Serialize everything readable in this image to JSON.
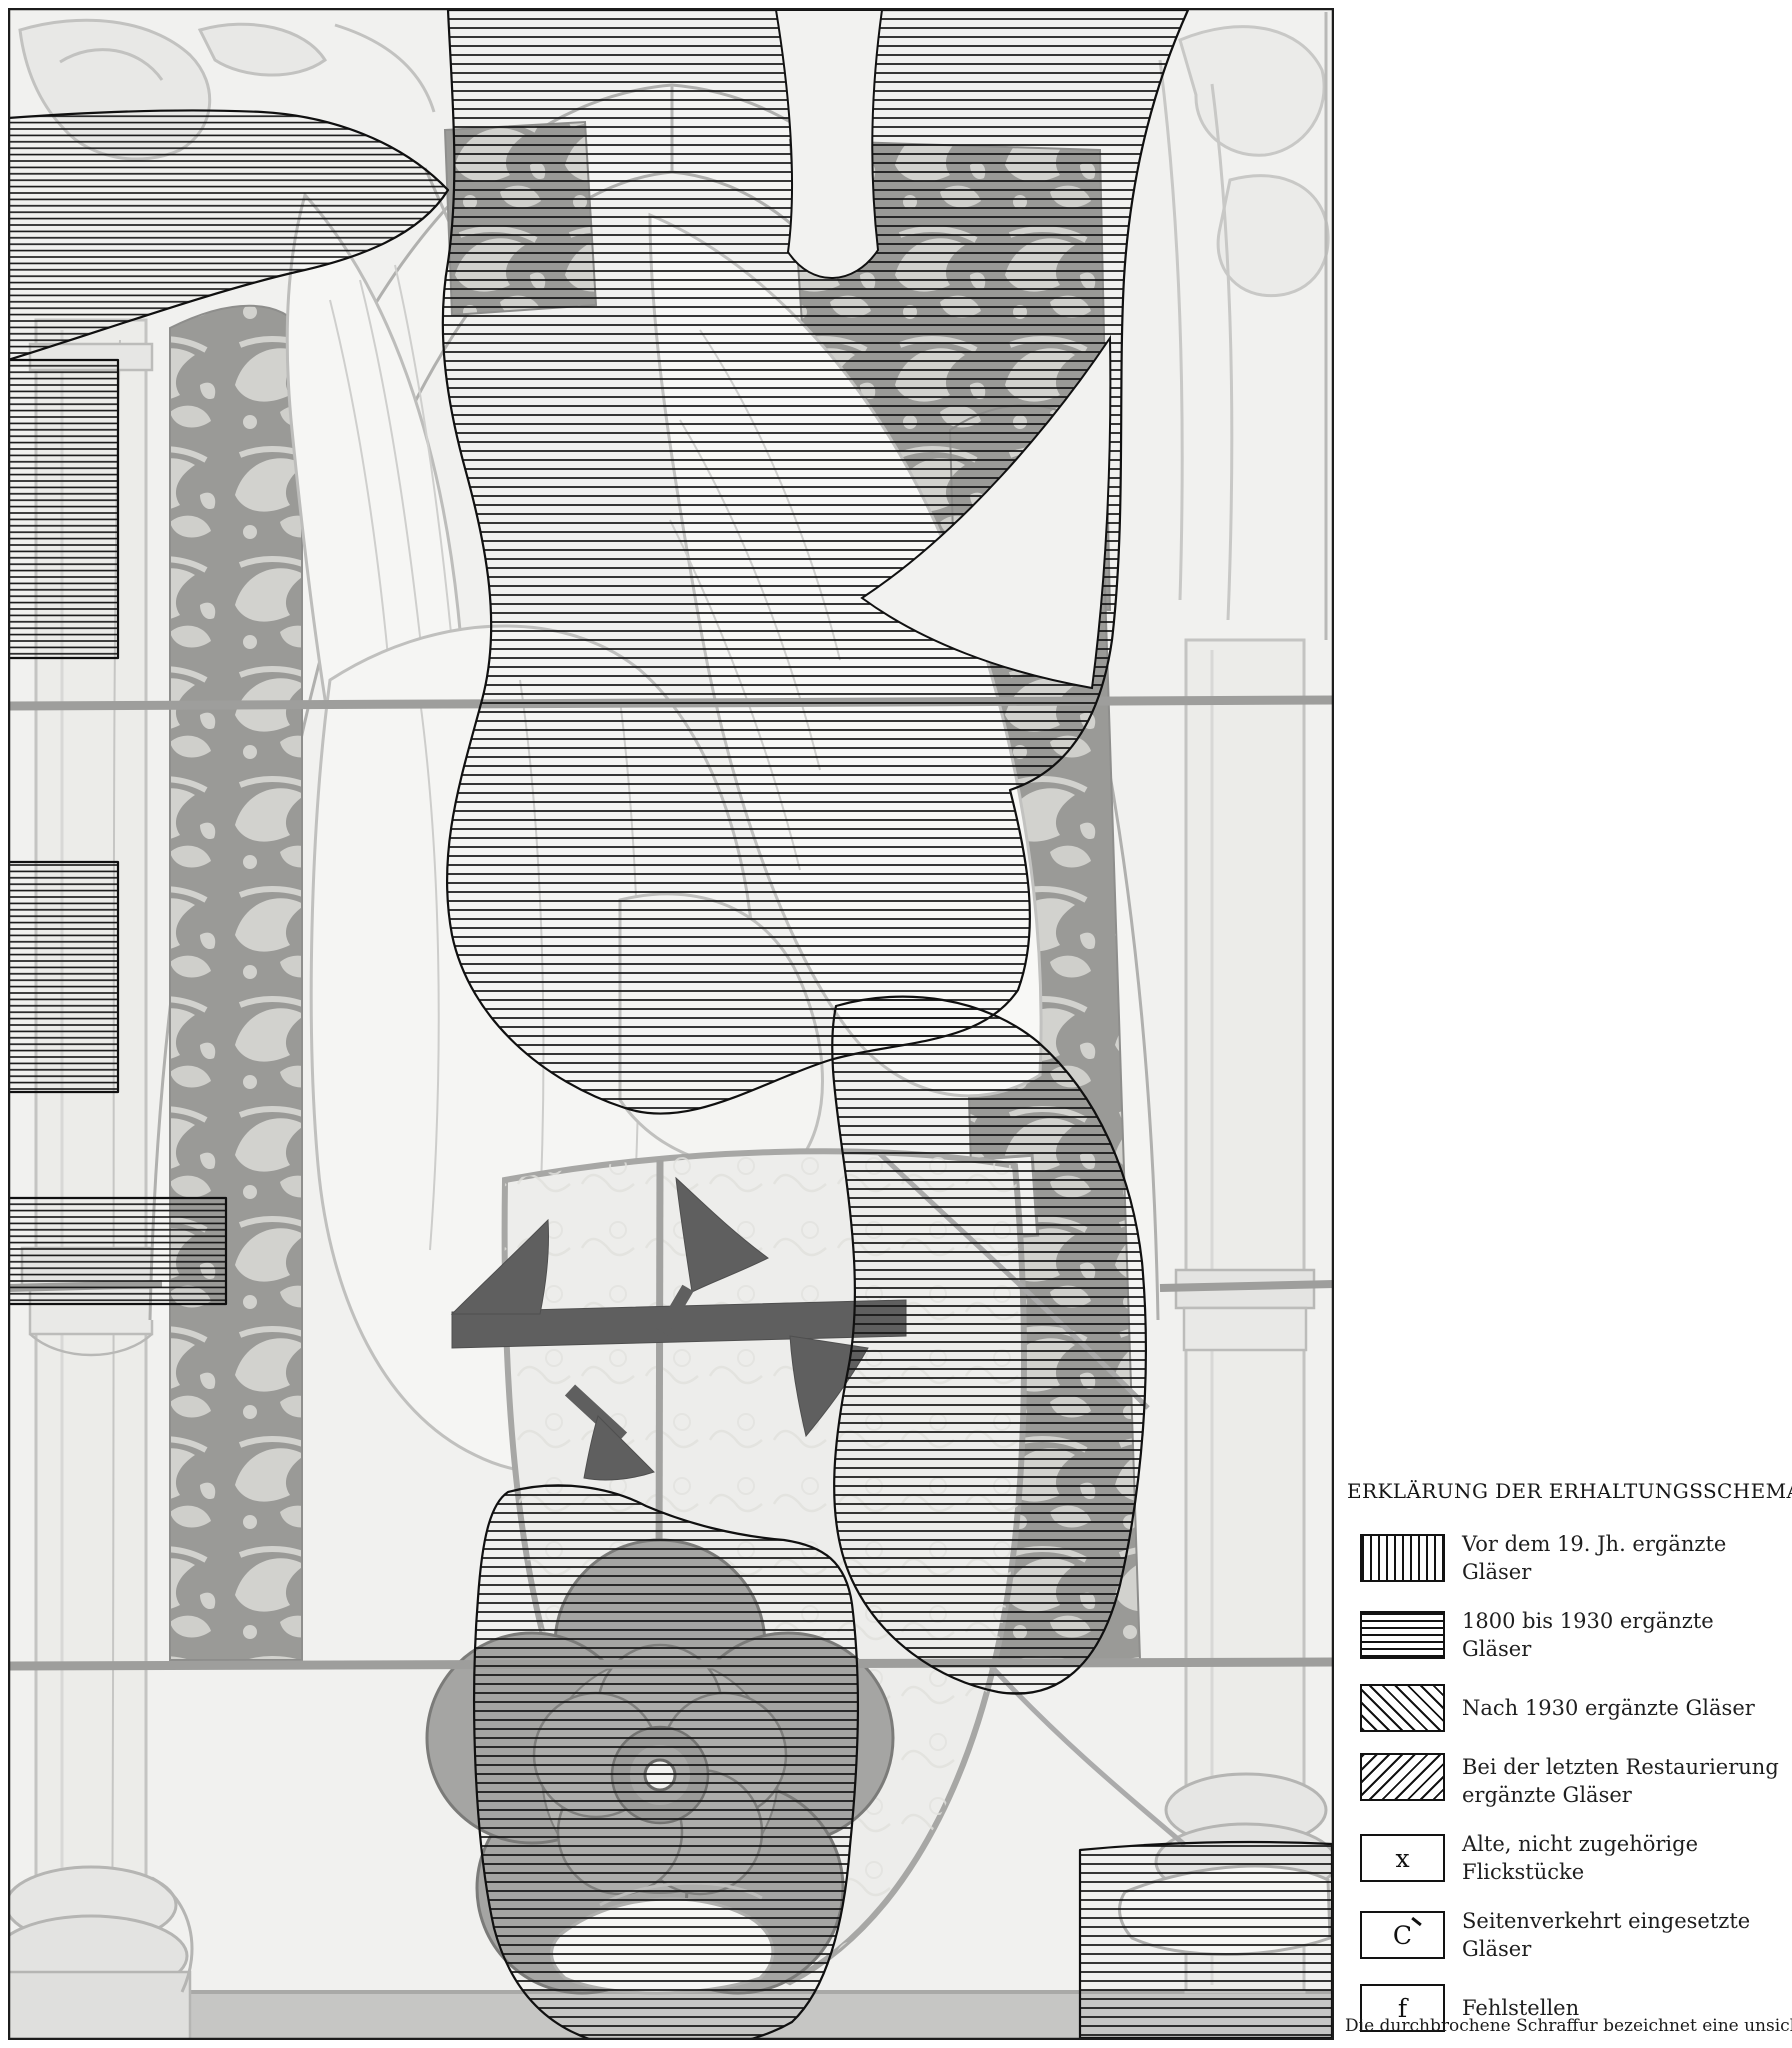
{
  "figure": {
    "description": "Grayscale photograph of a Gothic stained-glass panel: a kneeling angel with spread wings holds a shield bearing a dark merchant's mark above a large heraldic rose; ornamental damask borders, flanking columns and a round arch frame the scene. Areas of the panel are overlaid with outlined hatching indicating restoration campaigns.",
    "photo_border_color": "#1c1c1c",
    "hatch_color": "#111111"
  },
  "legend": {
    "title": "ERKLÄRUNG DER ERHALTUNGSSCHEMATA",
    "items": [
      {
        "swatch": "vertical-hatch",
        "label": "Vor dem 19. Jh. ergänzte Gläser"
      },
      {
        "swatch": "horizontal-hatch",
        "label": "1800 bis 1930 ergänzte Gläser"
      },
      {
        "swatch": "diagonal-hatch-backslash",
        "label": "Nach 1930 ergänzte Gläser"
      },
      {
        "swatch": "diagonal-hatch-slash",
        "label": "Bei der letzten Restaurierung ergänzte Gläser"
      },
      {
        "swatch": "symbol",
        "symbol": "x",
        "label": "Alte, nicht zugehörige Flickstücke"
      },
      {
        "swatch": "symbol",
        "symbol": "C",
        "label": "Seitenverkehrt eingesetzte Gläser"
      },
      {
        "swatch": "symbol",
        "symbol": "f",
        "label": "Fehlstellen"
      }
    ],
    "note": "Die durchbrochene Schraffur bezeichnet eine unsichere Angabe"
  }
}
